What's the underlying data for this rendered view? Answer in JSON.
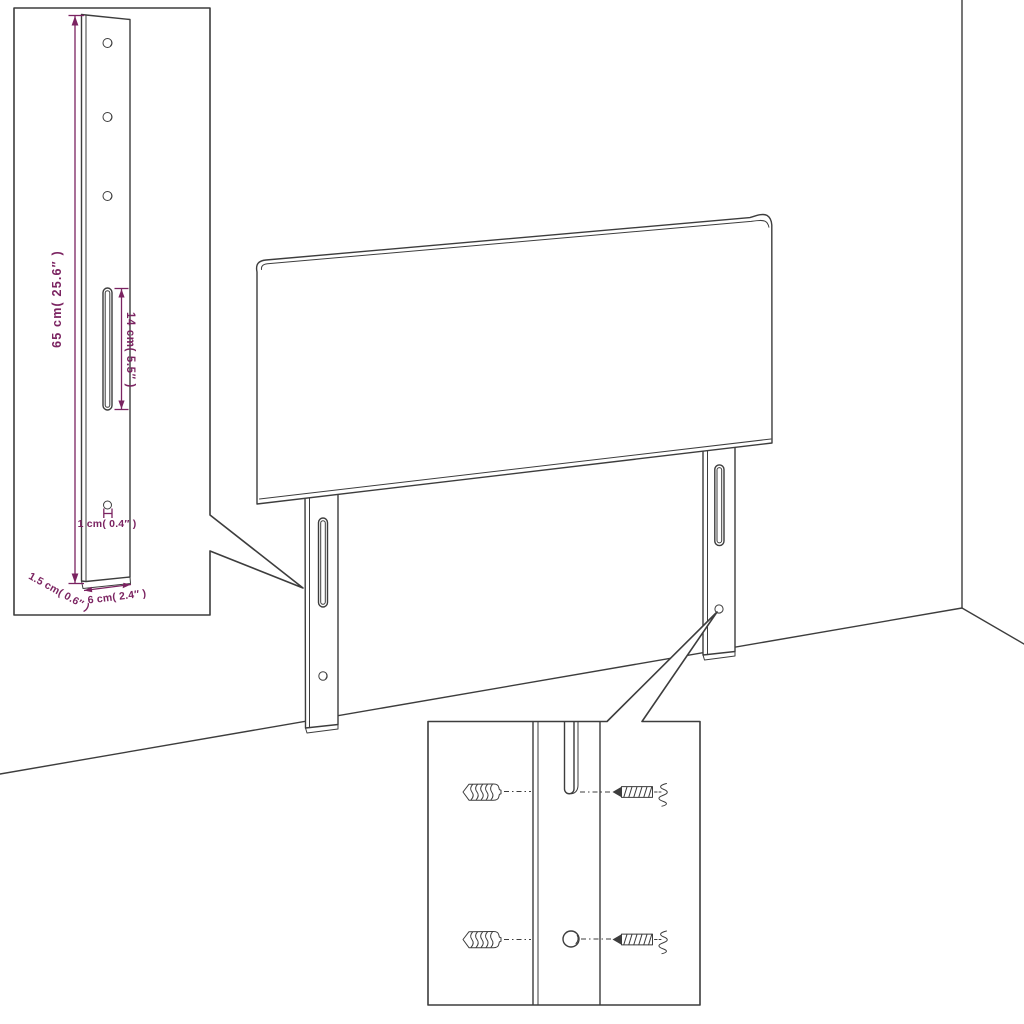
{
  "colors": {
    "line": "#3d3d3d",
    "dimension": "#7b2361",
    "background": "#ffffff"
  },
  "diagram": {
    "type": "product-dimension-diagram",
    "subject": "upholstered headboard with two mounting legs",
    "leg_detail_inset": {
      "labels": {
        "leg_height": "65 cm( 25.6″ )",
        "slot_length": "14 cm( 5.5″ )",
        "hole_diameter": "1 cm( 0.4″ )",
        "leg_thickness": "1.5 cm( 0.6″ )",
        "leg_width": "6 cm( 2.4″ )"
      },
      "hole_count": 4,
      "slot_count": 1
    },
    "mounting_detail_inset": {
      "wall_plug_count": 2,
      "screw_count": 2,
      "slot_count": 1,
      "hole_count": 1
    }
  }
}
